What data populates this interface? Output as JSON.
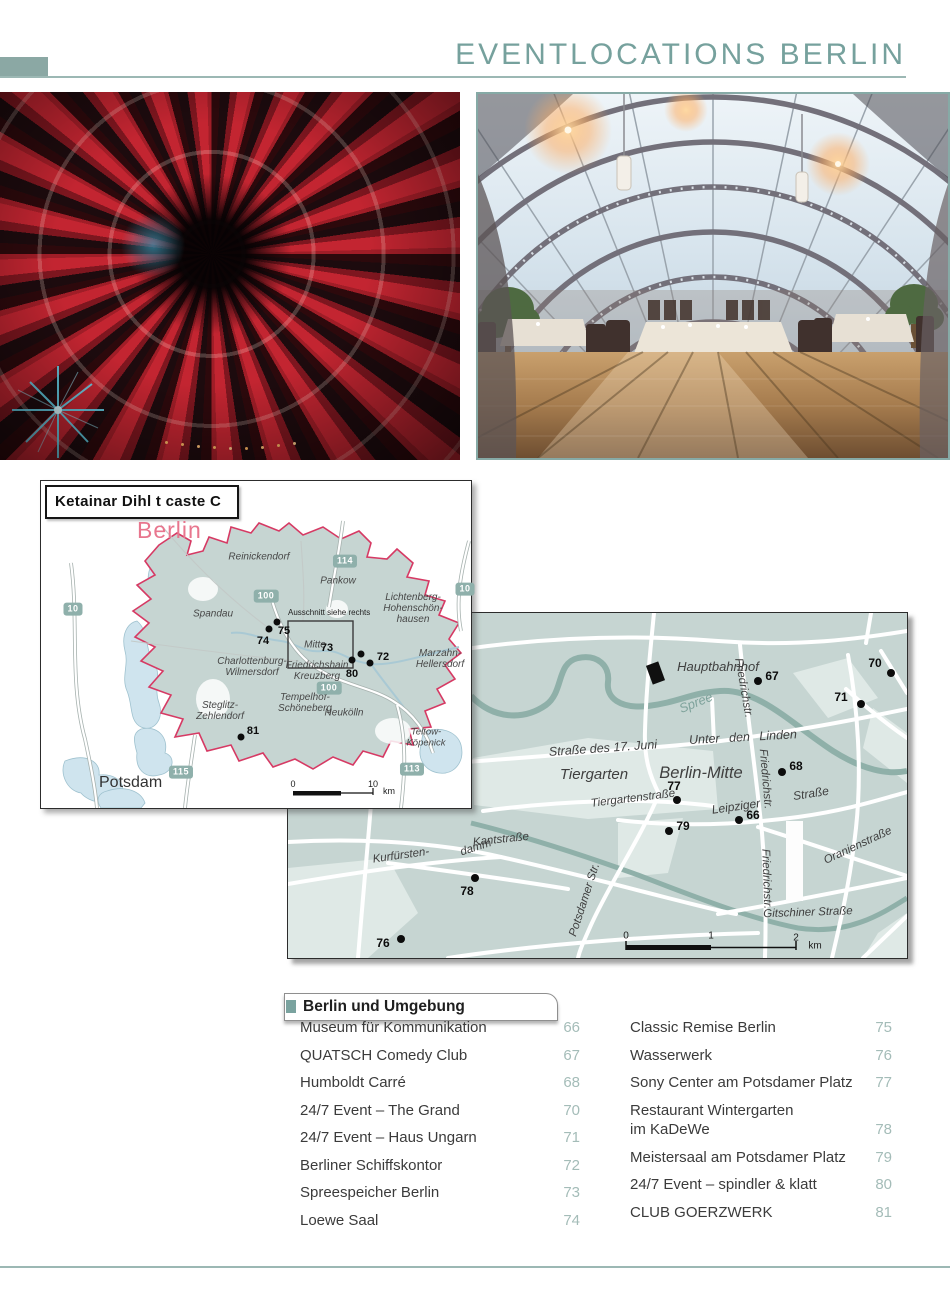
{
  "header": {
    "title": "EVENTLOCATIONS BERLIN"
  },
  "overview_map": {
    "credit": "Ketainar Dihl t caste C",
    "city_label": "Berlin",
    "inset_note": "Ausschnitt siehe rechts",
    "labels": {
      "reinickendorf": "Reinickendorf",
      "pankow": "Pankow",
      "spandau": "Spandau",
      "lichtenberg": "Lichtenberg-\nHohenschön-\nhausen",
      "marzahn": "Marzahn-\nHellersdorf",
      "mitte": "Mitte",
      "friedrichshain_kreuzberg": "Friedrichshain\nKreuzberg",
      "charlottenburg": "Charlottenburg-\nWilmersdorf",
      "tempelhof": "Tempelhof-\nSchöneberg",
      "steglitz": "Steglitz-\nZehlendorf",
      "neukoelln": "Neukölln",
      "teltow": "Teltow-Köpenick",
      "potsdam": "Potsdam"
    },
    "badges": {
      "a10_west": "10",
      "a100_north": "100",
      "a114": "114",
      "a10_east": "10",
      "a100_south": "100",
      "a115": "115",
      "a113": "113"
    },
    "markers": {
      "m74": "74",
      "m75": "75",
      "m73": "73",
      "m72": "72",
      "m80": "80",
      "m81": "81"
    },
    "scale": {
      "start": "0",
      "end": "10",
      "unit": "km"
    }
  },
  "detail_map": {
    "station": "Hauptbahnhof",
    "river": "Spree",
    "areas": {
      "tiergarten": "Tiergarten",
      "berlin_mitte": "Berlin-Mitte"
    },
    "streets": {
      "str17": "Straße des 17. Juni",
      "linden": "Unter den Linden",
      "friedrich_n": "Friedrichstr.",
      "friedrich_m": "Friedrichstr.",
      "friedrich_s": "Friedrichstr.",
      "tiergartenstr": "Tiergartenstraße",
      "leipziger": "Leipziger",
      "leipziger2": "Straße",
      "oranien": "Oranienstraße",
      "kant": "Kantstraße",
      "kurfuersten": "Kurfürsten-",
      "damm": "damm",
      "potsdamer": "Potsdamer Str.",
      "gitschiner": "Gitschiner Straße"
    },
    "markers": {
      "m66": "66",
      "m67": "67",
      "m68": "68",
      "m70": "70",
      "m71": "71",
      "m76": "76",
      "m77": "77",
      "m78": "78",
      "m79": "79"
    },
    "scale": {
      "t0": "0",
      "t1": "1",
      "t2": "2",
      "unit": "km"
    }
  },
  "directory": {
    "header": "Berlin und Umgebung",
    "left_column": [
      {
        "label": "Museum für Kommunikation",
        "page": "66"
      },
      {
        "label": "QUATSCH Comedy Club",
        "page": "67"
      },
      {
        "label": "Humboldt Carré",
        "page": "68"
      },
      {
        "label": "24/7 Event – The Grand",
        "page": "70"
      },
      {
        "label": "24/7 Event – Haus Ungarn",
        "page": "71"
      },
      {
        "label": "Berliner Schiffskontor",
        "page": "72"
      },
      {
        "label": "Spreespeicher Berlin",
        "page": "73"
      },
      {
        "label": "Loewe Saal",
        "page": "74"
      }
    ],
    "right_column": [
      {
        "label": "Classic Remise Berlin",
        "page": "75"
      },
      {
        "label": "Wasserwerk",
        "page": "76"
      },
      {
        "label": "Sony Center am Potsdamer Platz",
        "page": "77"
      },
      {
        "label": "Restaurant Wintergarten",
        "label2": "im KaDeWe",
        "page": "78"
      },
      {
        "label": "Meistersaal am Potsdamer Platz",
        "page": "79"
      },
      {
        "label": "24/7 Event – spindler & klatt",
        "page": "80"
      },
      {
        "label": "CLUB GOERZWERK",
        "page": "81"
      }
    ]
  },
  "colors": {
    "accent": "#76a19d",
    "rule": "#9cb8b4",
    "map_land": "#c6d5d2",
    "boundary_pink": "#d63a64",
    "city_label_pink": "#e8768e",
    "page_number": "#a4bcb8",
    "badge": "#8fb0ab",
    "water": "#cfe4ee",
    "waterway": "#8fb0a9"
  }
}
